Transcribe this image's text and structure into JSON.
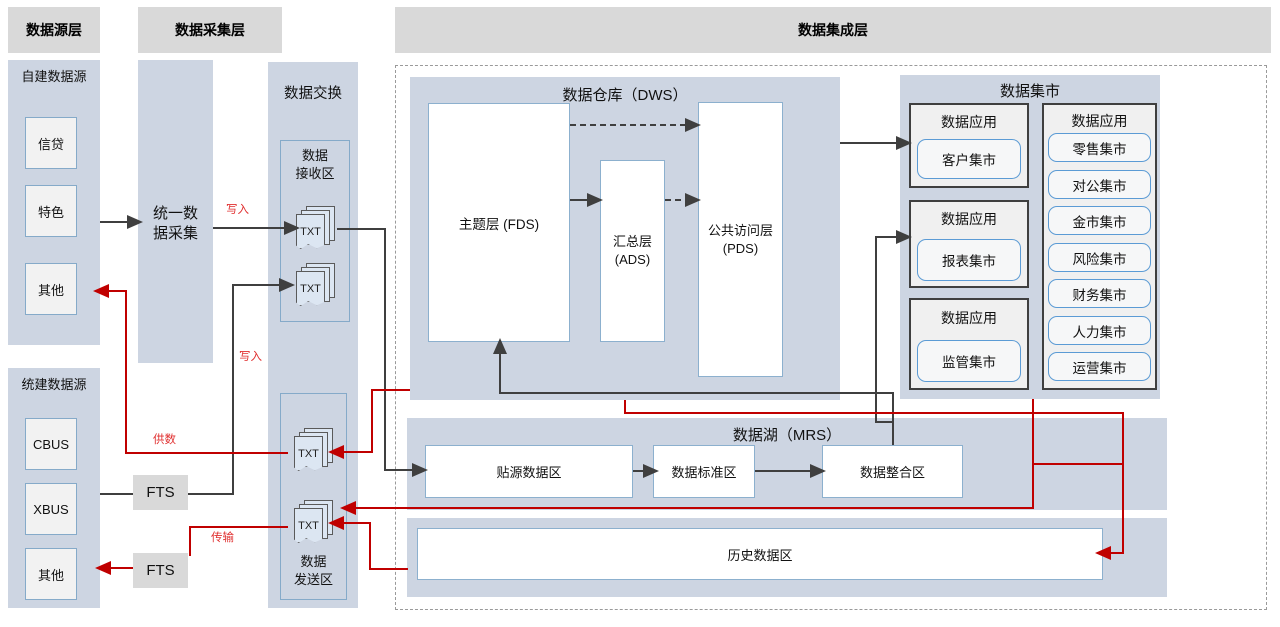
{
  "layers": {
    "source": "数据源层",
    "collect": "数据采集层",
    "integrate": "数据集成层"
  },
  "source": {
    "self_group": "自建数据源",
    "self_items": [
      "信贷",
      "特色",
      "其他"
    ],
    "unified_group": "统建数据源",
    "unified_items": [
      "CBUS",
      "XBUS",
      "其他"
    ]
  },
  "collect": {
    "unified_collect": "统一数\n据采集",
    "fts_label": "FTS"
  },
  "exchange": {
    "title": "数据交换",
    "recv_zone": "数据\n接收区",
    "send_zone": "数据\n发送区",
    "txt": "TXT"
  },
  "edge_labels": {
    "write1": "写入",
    "write2": "写入",
    "supply": "供数",
    "transfer": "传输"
  },
  "dws": {
    "title": "数据仓库（DWS）",
    "fds": "主题层 (FDS)",
    "ads": "汇总层\n(ADS)",
    "pds": "公共访问层\n(PDS)"
  },
  "marts": {
    "title": "数据集市",
    "app_label": "数据应用",
    "left": [
      "客户集市",
      "报表集市",
      "监管集市"
    ],
    "right": [
      "零售集市",
      "对公集市",
      "金市集市",
      "风险集市",
      "财务集市",
      "人力集市",
      "运营集市"
    ]
  },
  "mrs": {
    "title": "数据湖（MRS）",
    "zones": [
      "贴源数据区",
      "数据标准区",
      "数据整合区"
    ],
    "history": "历史数据区"
  }
}
